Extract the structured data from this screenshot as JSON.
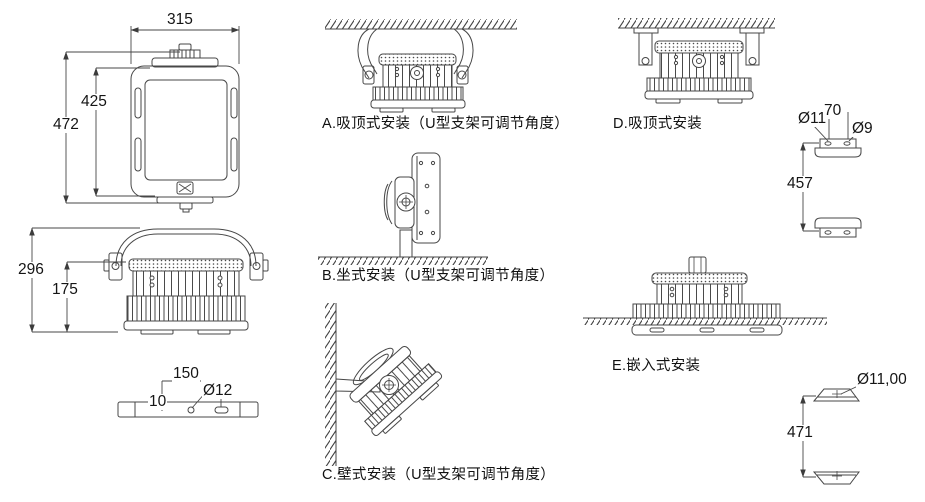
{
  "page": {
    "background_color": "#ffffff",
    "line_color": "#474747",
    "text_color": "#151515"
  },
  "front_view": {
    "width": "315",
    "inner_height": "425",
    "outer_height": "472"
  },
  "side_view": {
    "total_height": "296",
    "body_height": "175"
  },
  "bottom_view": {
    "hole_spacing": "150",
    "slot_diameter": "Ø12",
    "edge_offset": "10"
  },
  "mounts": {
    "a": "A.吸顶式安装（U型支架可调节角度）",
    "b": "B.坐式安装（U型支架可调节角度）",
    "c": "C.壁式安装（U型支架可调节角度）",
    "d": "D.吸顶式安装",
    "e": "E.嵌入式安装"
  },
  "bracket_top": {
    "hole_left_diameter": "Ø11",
    "hole_spacing": "70",
    "hole_right_diameter": "Ø9",
    "mount_distance": "457"
  },
  "bracket_bottom": {
    "hole_diameter": "Ø11,00",
    "mount_distance": "471"
  }
}
